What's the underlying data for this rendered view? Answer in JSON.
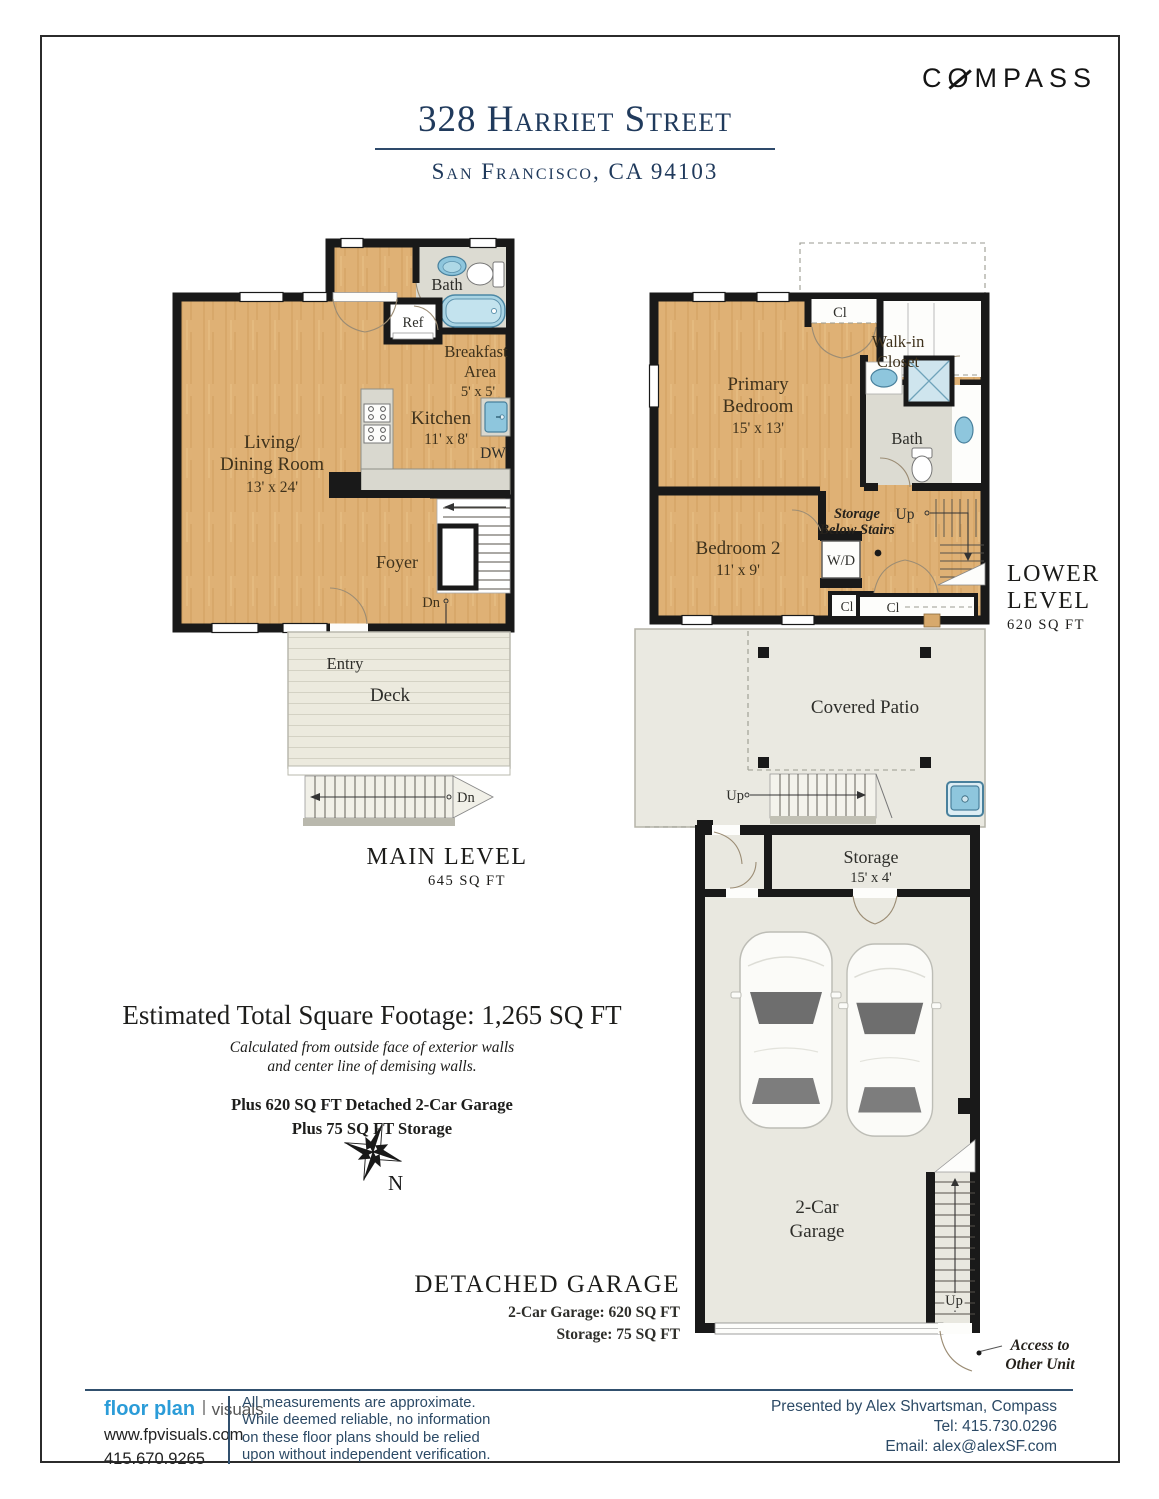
{
  "page": {
    "brand_c": "C",
    "brand_rest": "MPASS",
    "brand_o": "O",
    "title": "328 Harriet Street",
    "subtitle": "San Francisco, CA 94103"
  },
  "main_level": {
    "title": "MAIN LEVEL",
    "area": "645 SQ FT",
    "living_line1": "Living/",
    "living_line2": "Dining Room",
    "living_dims": "13' x 24'",
    "kitchen_label": "Kitchen",
    "kitchen_dims": "11' x 8'",
    "breakfast_line1": "Breakfast",
    "breakfast_line2": "Area",
    "breakfast_dims": "5' x 5'",
    "bath_label": "Bath",
    "ref_label": "Ref",
    "dw_label": "DW",
    "foyer_label": "Foyer",
    "stairs_down": "Dn",
    "entry_label": "Entry",
    "deck_label": "Deck",
    "deck_down": "Dn"
  },
  "lower_level": {
    "title_line1": "LOWER",
    "title_line2": "LEVEL",
    "area": "620 SQ FT",
    "primary_line1": "Primary",
    "primary_line2": "Bedroom",
    "primary_dims": "15' x 13'",
    "closet_top": "Cl",
    "walkin_line1": "Walk-in",
    "walkin_line2": "Closet",
    "bath_label": "Bath",
    "bedroom2_label": "Bedroom 2",
    "bedroom2_dims": "11' x 9'",
    "storage_line1": "Storage",
    "storage_line2": "Below Stairs",
    "stairs_up": "Up",
    "washer_dryer": "W/D",
    "closet_small": "Cl",
    "closet_wide": "Cl",
    "patio_label": "Covered Patio",
    "patio_up": "Up"
  },
  "garage": {
    "title": "DETACHED GARAGE",
    "sub_line1": "2-Car Garage: 620 SQ FT",
    "sub_line2": "Storage: 75 SQ FT",
    "storage_label": "Storage",
    "storage_dims": "15' x 4'",
    "label_line1": "2-Car",
    "label_line2": "Garage",
    "stairs_up": "Up",
    "access_line1": "Access to",
    "access_line2": "Other Unit"
  },
  "summary": {
    "total": "Estimated Total Square Footage: 1,265 SQ FT",
    "note_line1": "Calculated from outside face of exterior walls",
    "note_line2": "and center line of demising walls.",
    "plus_line1": "Plus 620 SQ FT Detached 2-Car Garage",
    "plus_line2": "Plus 75 SQ FT Storage",
    "north_label": "N"
  },
  "footer": {
    "logo_primary": "floor plan",
    "logo_secondary": "visuals",
    "website": "www.fpvisuals.com",
    "phone": "415.670.9265",
    "disclaimer_line1": "All measurements are approximate.",
    "disclaimer_line2": "While deemed reliable, no information",
    "disclaimer_line3": "on these floor plans should be relied",
    "disclaimer_line4": "upon without independent verification.",
    "presented_by": "Presented by Alex Shvartsman, Compass",
    "tel": "Tel: 415.730.0296",
    "email": "Email: alex@alexSF.com"
  },
  "colors": {
    "navy": "#203a5c",
    "wall": "#191919",
    "wood_floor": "#dfb175",
    "outdoor_floor": "#e9e8e0",
    "bath_floor": "#dcdbd2",
    "fixture_blue": "#8ec6dd",
    "logo_blue": "#2b9cd8",
    "footer_text": "#2c4a66"
  }
}
